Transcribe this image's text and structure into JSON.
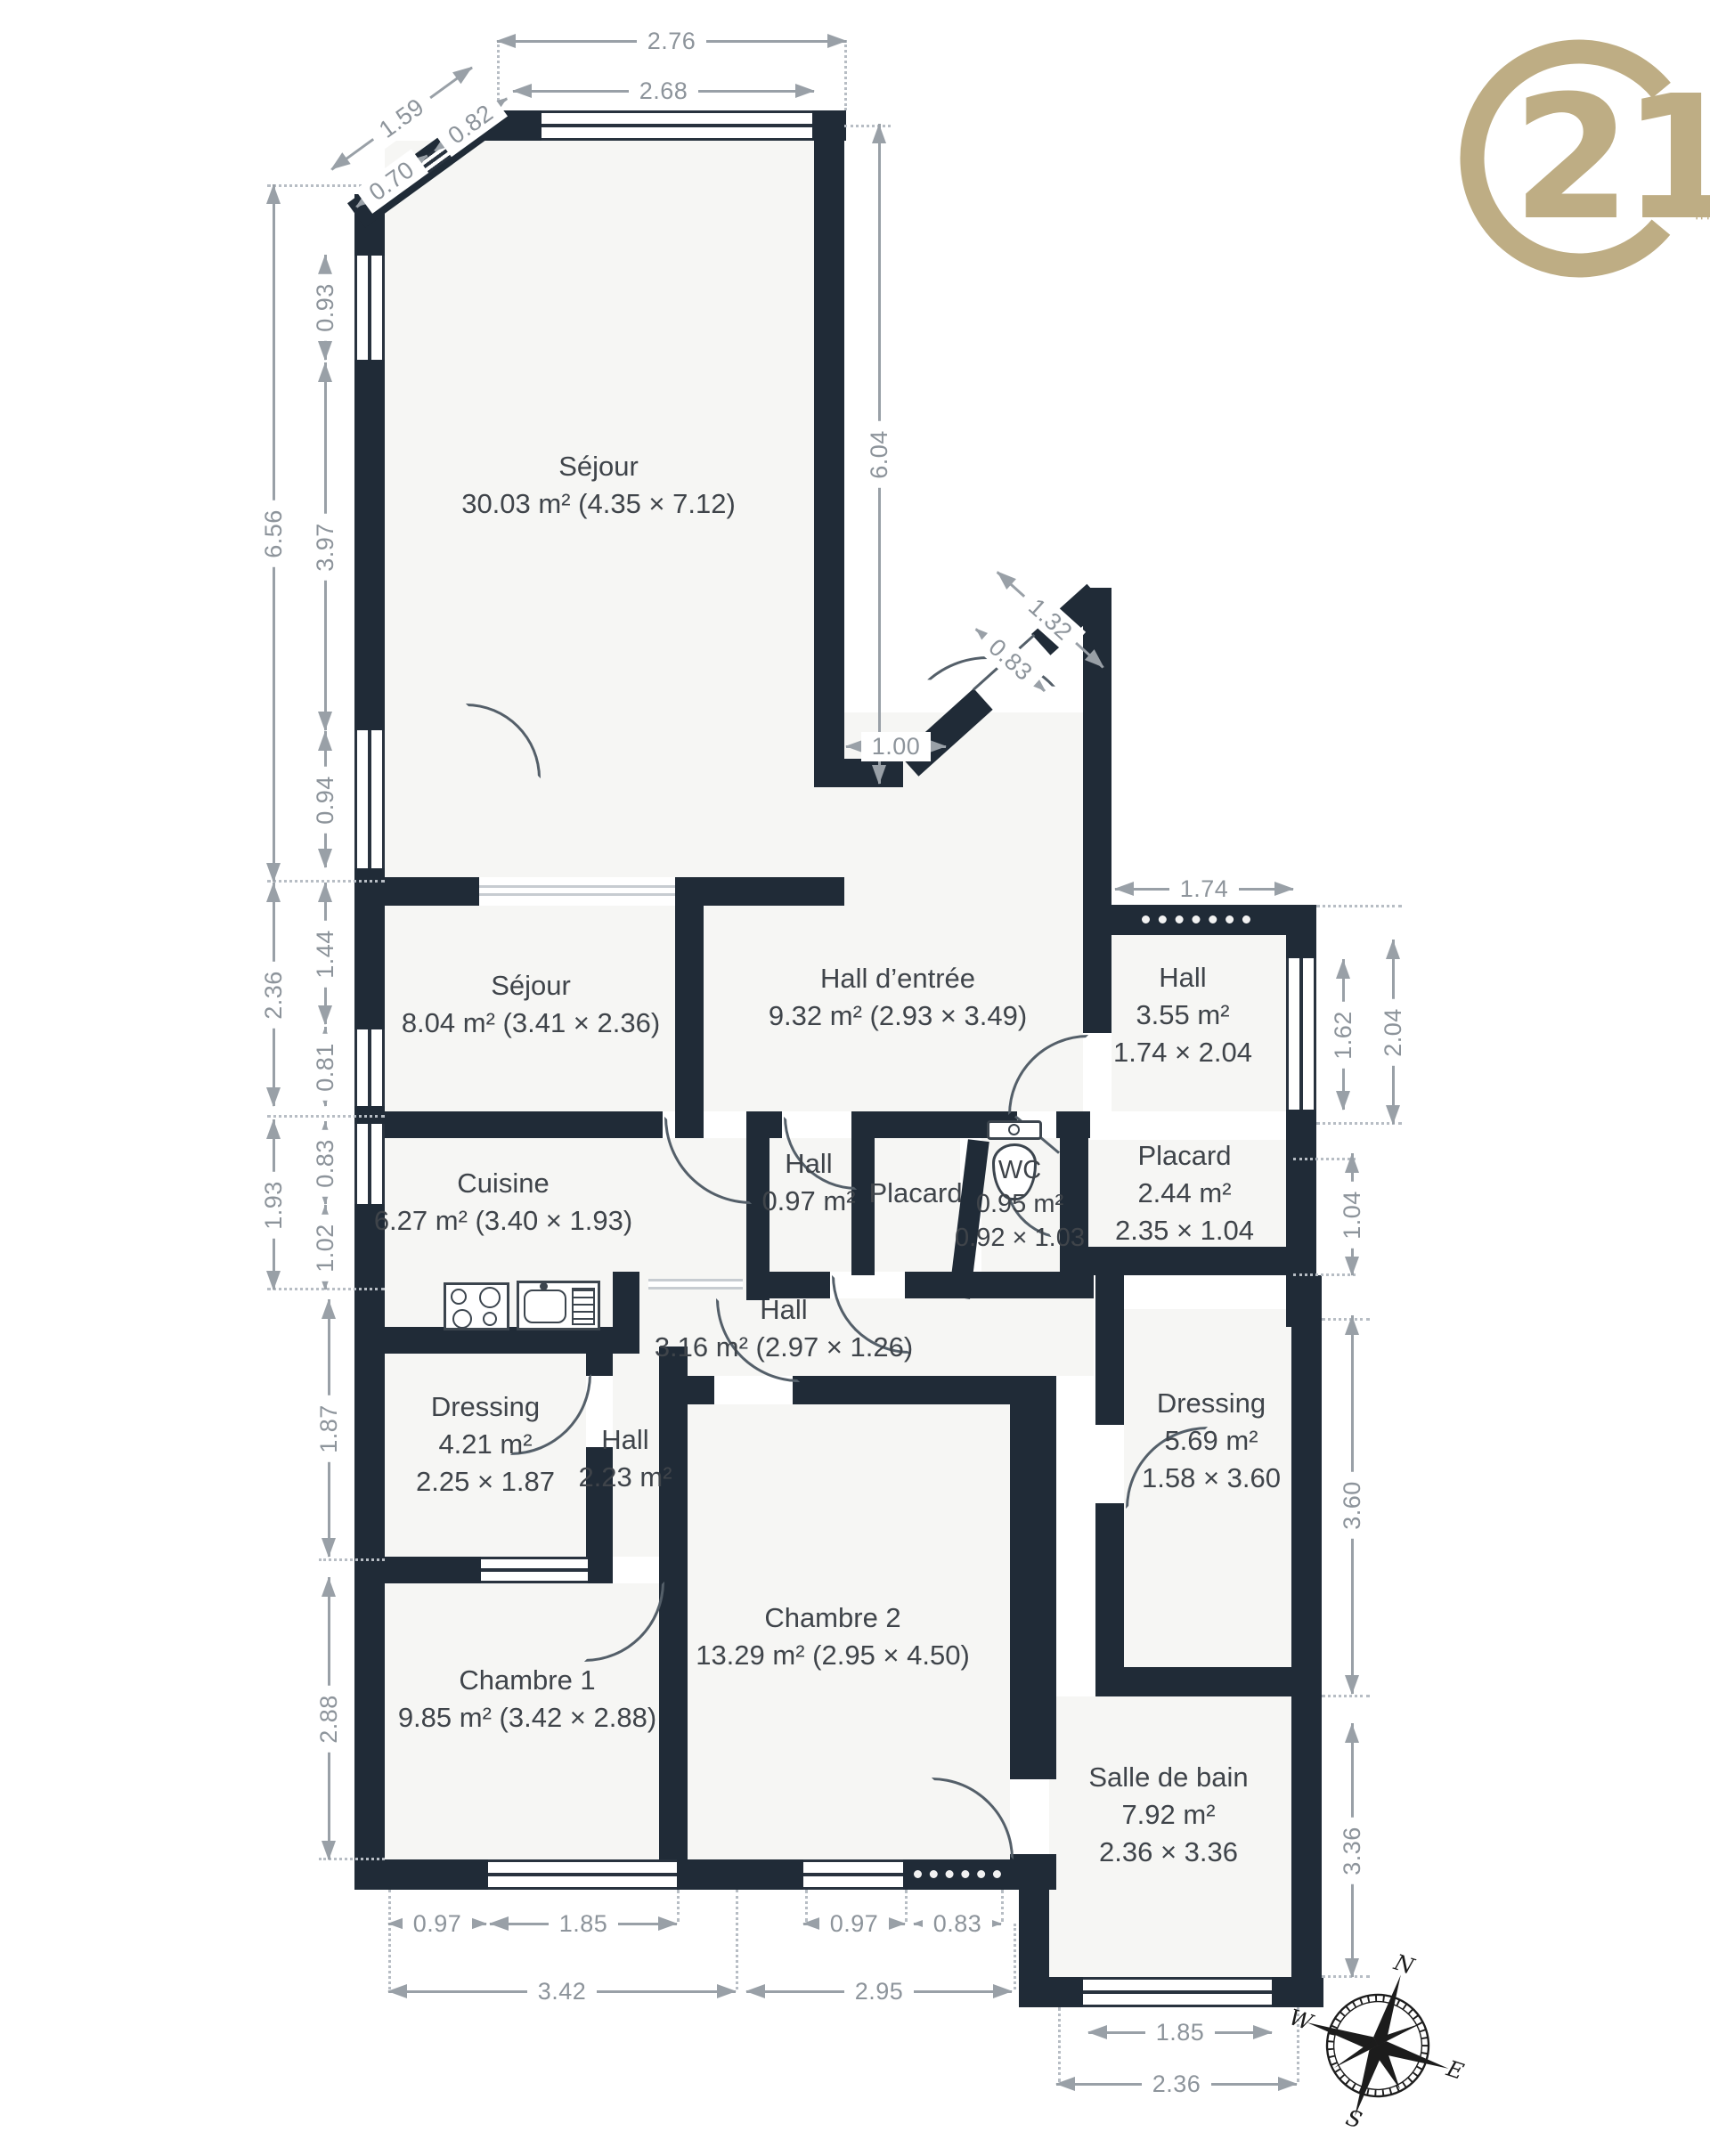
{
  "title": "Floor plan",
  "logo": {
    "brand": "Century 21",
    "number": "21",
    "trademark": "™",
    "color": "#BEAD84"
  },
  "compass": {
    "n": "N",
    "e": "E",
    "s": "S",
    "w": "W"
  },
  "rooms": [
    {
      "id": "sejour-1",
      "lines": [
        "Séjour",
        "30.03 m² (4.35 × 7.12)"
      ]
    },
    {
      "id": "sejour-2",
      "lines": [
        "Séjour",
        "8.04 m² (3.41 × 2.36)"
      ]
    },
    {
      "id": "hall-entree",
      "lines": [
        "Hall d’entrée",
        "9.32 m² (2.93 × 3.49)"
      ]
    },
    {
      "id": "hall-355",
      "lines": [
        "Hall",
        "3.55 m²",
        "1.74 × 2.04"
      ]
    },
    {
      "id": "cuisine",
      "lines": [
        "Cuisine",
        "6.27 m² (3.40 × 1.93)"
      ]
    },
    {
      "id": "hall-097",
      "lines": [
        "Hall",
        "0.97 m²"
      ]
    },
    {
      "id": "placard-1",
      "lines": [
        "Placard"
      ]
    },
    {
      "id": "wc",
      "lines": [
        "WC",
        "0.95 m²",
        "0.92 × 1.03"
      ]
    },
    {
      "id": "placard-2",
      "lines": [
        "Placard",
        "2.44 m²",
        "2.35 × 1.04"
      ]
    },
    {
      "id": "hall-316",
      "lines": [
        "Hall",
        "3.16 m² (2.97 × 1.26)"
      ]
    },
    {
      "id": "dressing-1",
      "lines": [
        "Dressing",
        "4.21 m²",
        "2.25 × 1.87"
      ]
    },
    {
      "id": "hall-223",
      "lines": [
        "Hall",
        "2.23 m²"
      ]
    },
    {
      "id": "dressing-2",
      "lines": [
        "Dressing",
        "5.69 m²",
        "1.58 × 3.60"
      ]
    },
    {
      "id": "chambre-2",
      "lines": [
        "Chambre 2",
        "13.29 m² (2.95 × 4.50)"
      ]
    },
    {
      "id": "chambre-1",
      "lines": [
        "Chambre 1",
        "9.85 m² (3.42 × 2.88)"
      ]
    },
    {
      "id": "salle-de-bain",
      "lines": [
        "Salle de bain",
        "7.92 m²",
        "2.36 × 3.36"
      ]
    }
  ],
  "dims": [
    "6.56",
    "0.93",
    "3.97",
    "0.94",
    "2.36",
    "1.44",
    "0.81",
    "1.93",
    "0.83",
    "1.02",
    "1.87",
    "2.88",
    "2.76",
    "2.68",
    "1.59",
    "0.70",
    "0.82",
    "6.04",
    "1.00",
    "1.32",
    "0.83",
    "1.74",
    "1.62",
    "2.04",
    "1.04",
    "3.60",
    "3.36",
    "0.97",
    "1.85",
    "3.42",
    "0.97",
    "0.83",
    "2.95",
    "1.85",
    "2.36"
  ]
}
